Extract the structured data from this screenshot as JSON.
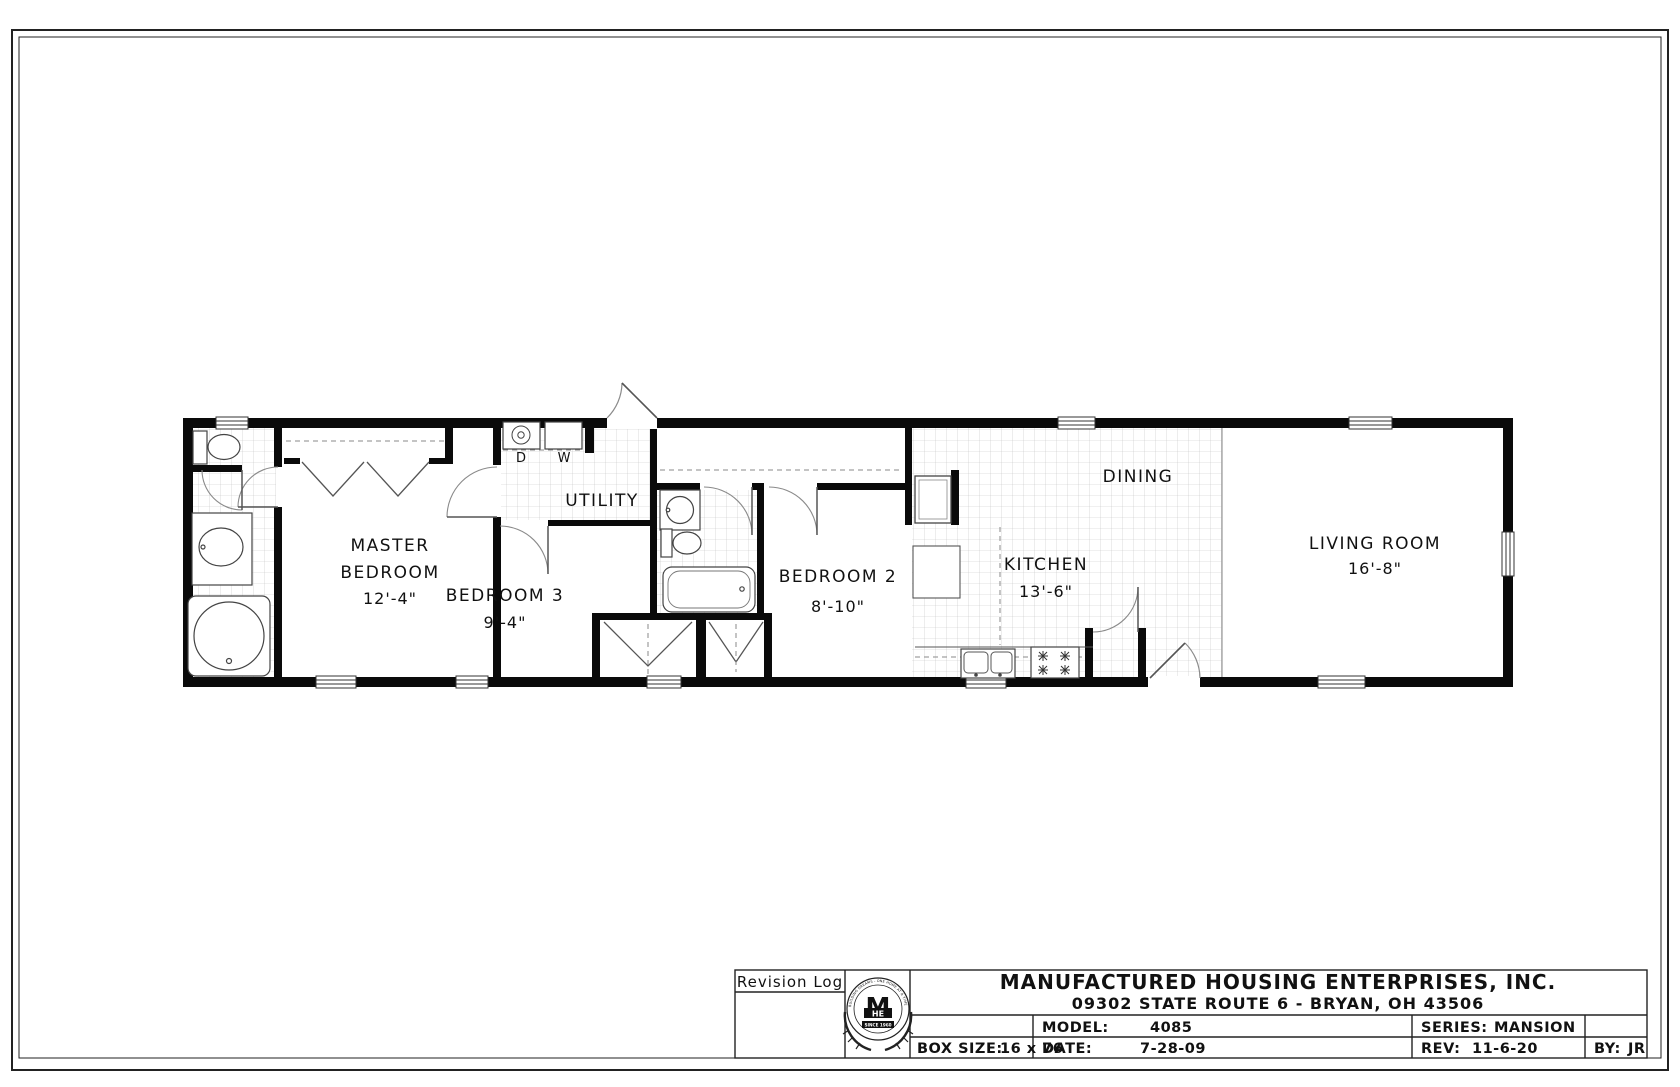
{
  "plan": {
    "rooms": {
      "master": {
        "line1": "MASTER",
        "line2": "BEDROOM",
        "dim": "12'-4\""
      },
      "bedroom3": {
        "line1": "BEDROOM 3",
        "dim": "9'-4\""
      },
      "bedroom2": {
        "line1": "BEDROOM 2",
        "dim": "8'-10\""
      },
      "kitchen": {
        "line1": "KITCHEN",
        "dim": "13'-6\""
      },
      "living": {
        "line1": "LIVING ROOM",
        "dim": "16'-8\""
      },
      "dining": {
        "line1": "DINING"
      },
      "utility": {
        "line1": "UTILITY"
      }
    },
    "appliances": {
      "dryer": "D",
      "washer": "W"
    }
  },
  "title_block": {
    "revision_log": "Revision Log",
    "company": "MANUFACTURED HOUSING ENTERPRISES, INC.",
    "address": "09302 STATE ROUTE 6 - BRYAN, OH 43506",
    "fields": {
      "model_label": "MODEL:",
      "model": "4085",
      "series_label": "SERIES:",
      "series": "MANSION",
      "box_label": "BOX SIZE:",
      "box": "16 x 76",
      "date_label": "DATE:",
      "date": "7-28-09",
      "rev_label": "REV:",
      "rev": "11-6-20",
      "by_label": "BY:",
      "by": "JR"
    },
    "logo": {
      "ring": "BUILDING DREAMS - ONE HOME AT A TIME",
      "m": "M",
      "he": "HE",
      "since": "SINCE 1960"
    }
  },
  "colors": {
    "wall": "#0a0a0a",
    "tile_line": "#c4c4c4",
    "fixture": "#444444",
    "arc": "#8a8a8a"
  }
}
